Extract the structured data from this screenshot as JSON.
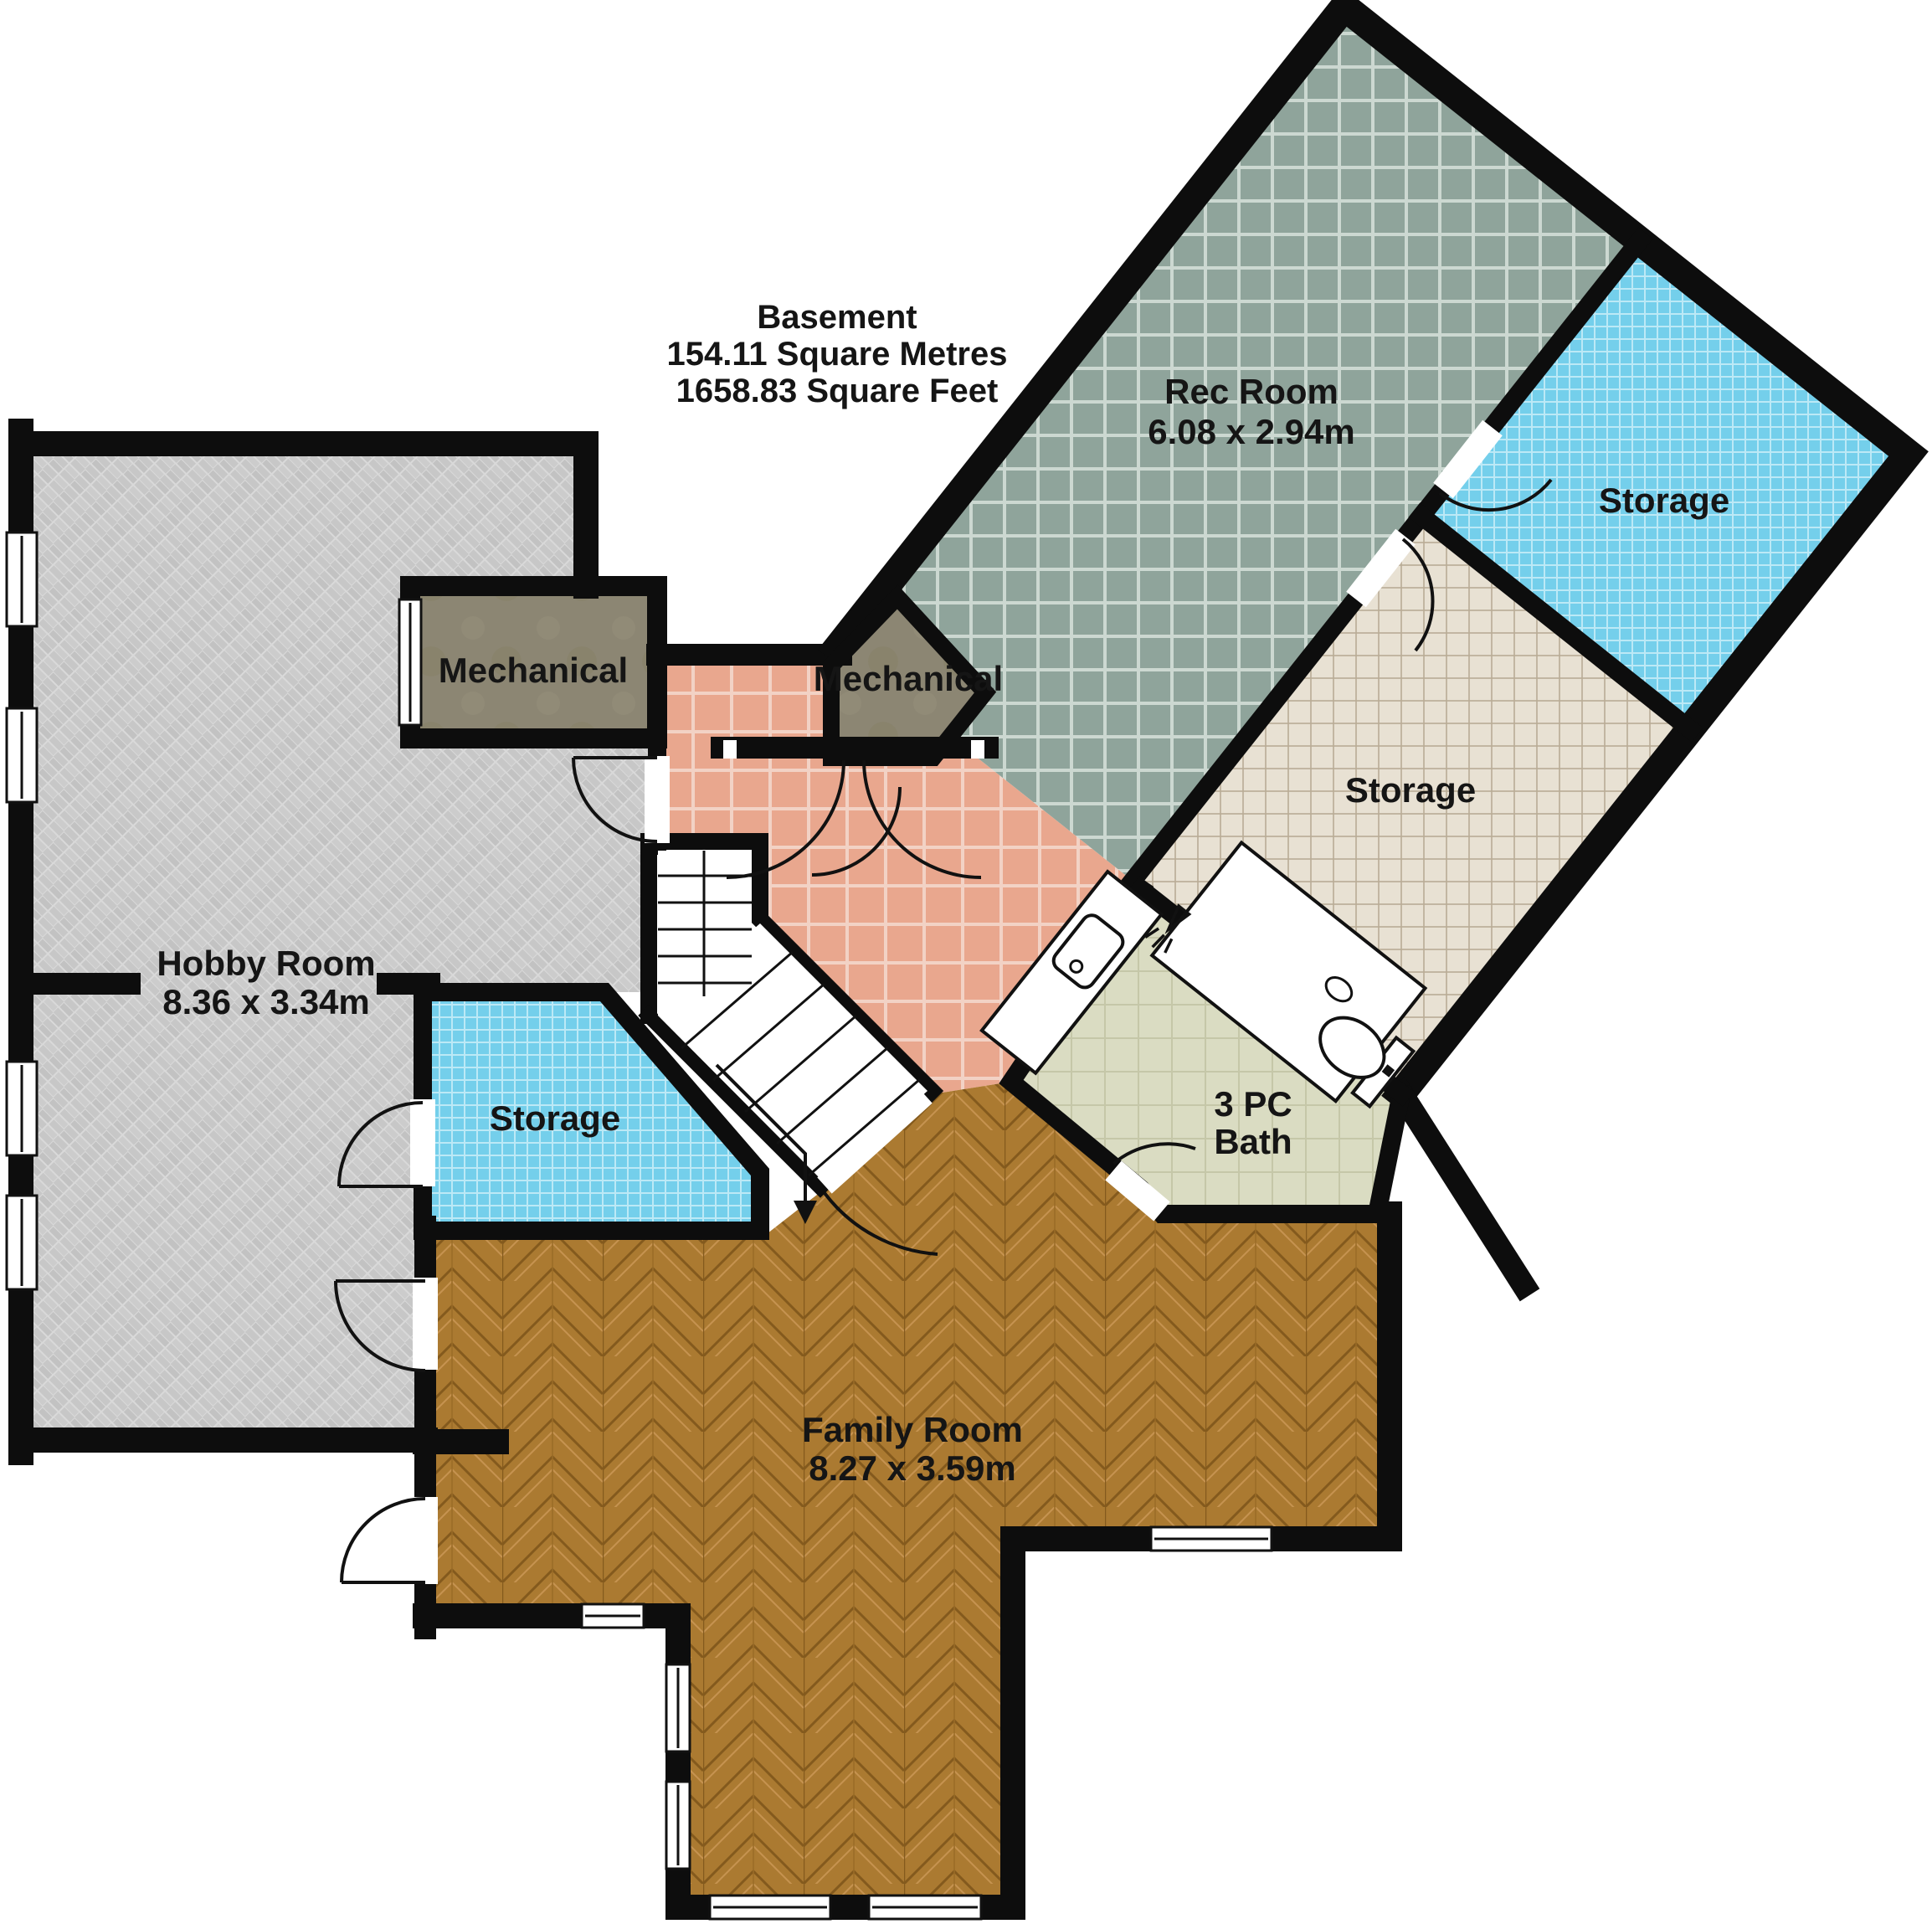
{
  "title": {
    "name": "Basement",
    "area_metric": "154.11 Square Metres",
    "area_imperial": "1658.83 Square Feet"
  },
  "rooms": {
    "rec_room": {
      "label": "Rec Room",
      "dimensions": "6.08 x 2.94m"
    },
    "storage_top_right": {
      "label": "Storage"
    },
    "storage_middle": {
      "label": "Storage"
    },
    "storage_left": {
      "label": "Storage"
    },
    "mechanical_left": {
      "label": "Mechanical"
    },
    "mechanical_right": {
      "label": "Mechanical"
    },
    "bath": {
      "label_line1": "3 PC",
      "label_line2": "Bath"
    },
    "family_room": {
      "label": "Family Room",
      "dimensions": "8.27 x 3.59m"
    },
    "hobby_room": {
      "label": "Hobby Room",
      "dimensions": "8.36 x 3.34m"
    }
  },
  "colors": {
    "wall": "#0d0d0d",
    "rec_tile": "#8fa49b",
    "blue_tile": "#74cfeb",
    "beige_tile": "#e8e1d3",
    "salmon_tile": "#e9a78e",
    "bath_tile": "#dadcc2",
    "wood": "#ab7a31",
    "herringbone": "#c8c8c8",
    "mechanical": "#8c8673"
  }
}
